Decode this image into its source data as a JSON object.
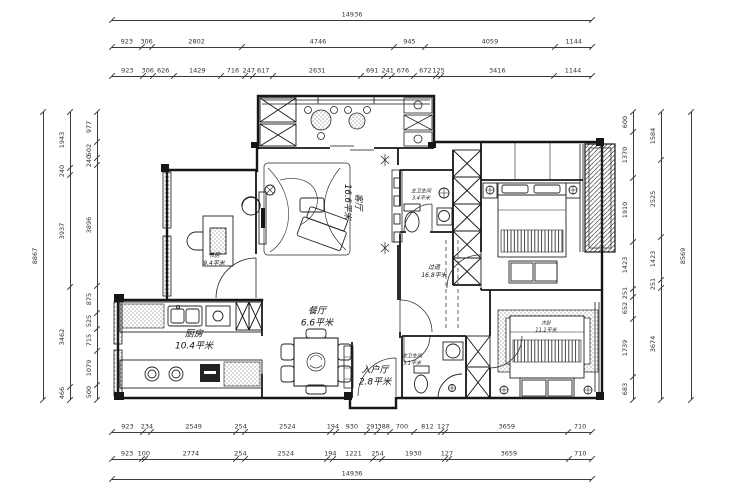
{
  "drawing": {
    "type": "residential floor plan",
    "line_color": "#1a1a1a",
    "background": "#ffffff"
  },
  "rooms": {
    "living": {
      "name": "客厅",
      "area": "16.6平米"
    },
    "dining": {
      "name": "餐厅",
      "area": "6.6平米"
    },
    "kitchen": {
      "name": "厨房",
      "area": "10.4平米"
    },
    "entry": {
      "name": "入户厅",
      "area": "2.8平米"
    },
    "study": {
      "name": "书房",
      "area": "9.4平米"
    },
    "master_bath": {
      "name": "主卫生间",
      "area": "3.4平米"
    },
    "hallway": {
      "name": "过道",
      "area": "16.8平米"
    },
    "second_bath": {
      "name": "次卫生间",
      "area": "3.1平米"
    },
    "second_bedroom": {
      "name": "次卧",
      "area": "11.1平米"
    }
  },
  "dims": {
    "top": {
      "total": [
        14936
      ],
      "row2": [
        923,
        306,
        2802,
        4746,
        945,
        4059,
        1144
      ],
      "row3": [
        923,
        306,
        626,
        1429,
        716,
        247,
        617,
        2631,
        691,
        241,
        676,
        672,
        125,
        3416,
        1144
      ]
    },
    "bottom": {
      "row1": [
        923,
        234,
        2549,
        254,
        2524,
        194,
        930,
        291,
        388,
        700,
        812,
        127,
        3659,
        710
      ],
      "row2": [
        923,
        100,
        2774,
        254,
        2524,
        194,
        1221,
        254,
        1930,
        127,
        3659,
        710
      ],
      "total": [
        14936
      ]
    },
    "left": {
      "outer_total": [
        8867
      ],
      "middle": [
        1943,
        240,
        3937,
        3462,
        466
      ],
      "inner": [
        977,
        502,
        240,
        3896,
        875,
        525,
        715,
        1079,
        500
      ]
    },
    "right": {
      "inner": [
        600,
        1370,
        1910,
        1423,
        251,
        652,
        1739,
        683
      ],
      "middle": [
        1584,
        2525,
        1423,
        251,
        3674
      ],
      "outer_total": [
        8569
      ]
    }
  }
}
